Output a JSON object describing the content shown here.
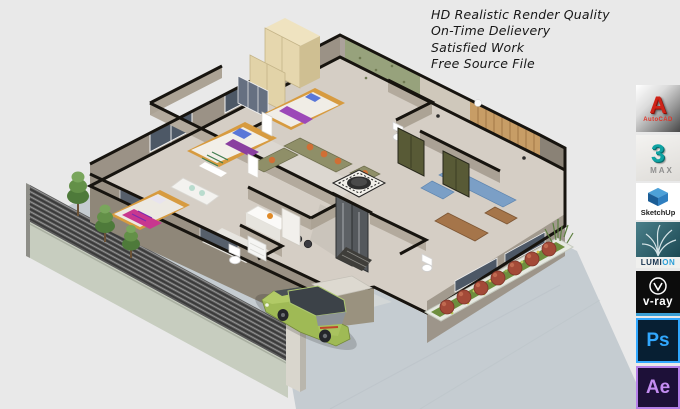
{
  "promo": {
    "lines": [
      "HD Realistic Render Quality",
      "On-Time Delievery",
      "Satisfied Work",
      "Free Source File"
    ]
  },
  "logo_strip": {
    "tiles": [
      {
        "id": "autocad",
        "software": "AutoCAD",
        "glyph": "A",
        "label": "AutoCAD",
        "accent": "#cf2318"
      },
      {
        "id": "3ds-max",
        "software": "3ds Max",
        "glyph": "3",
        "label": "MAX",
        "accent": "#0fa3a3"
      },
      {
        "id": "sketchup",
        "software": "SketchUp",
        "label": "SketchUp",
        "accent": "#2a7fc0"
      },
      {
        "id": "lumion",
        "software": "Lumion",
        "label_pre": "LUMI",
        "label_suffix": "ON",
        "accent": "#2d9fd8"
      },
      {
        "id": "v-ray",
        "software": "V-Ray",
        "label": "v-ray",
        "accent": "#ffffff"
      },
      {
        "id": "photoshop",
        "software": "Adobe Photoshop",
        "glyph": "Ps",
        "accent": "#31a8ff"
      },
      {
        "id": "after-effects",
        "software": "Adobe After Effects",
        "glyph": "Ae",
        "accent": "#c48df2"
      }
    ]
  },
  "scene": {
    "type": "isometric-3d-floor-plan-render",
    "background": "#e9e9e9",
    "car_color": "#a3bd55",
    "elements": [
      "house-floorplan",
      "boundary-fence",
      "trees",
      "garden-planter",
      "green-car",
      "driveway",
      "entrance-door",
      "bedrooms",
      "living-room",
      "kitchen-bar",
      "bathrooms"
    ]
  }
}
